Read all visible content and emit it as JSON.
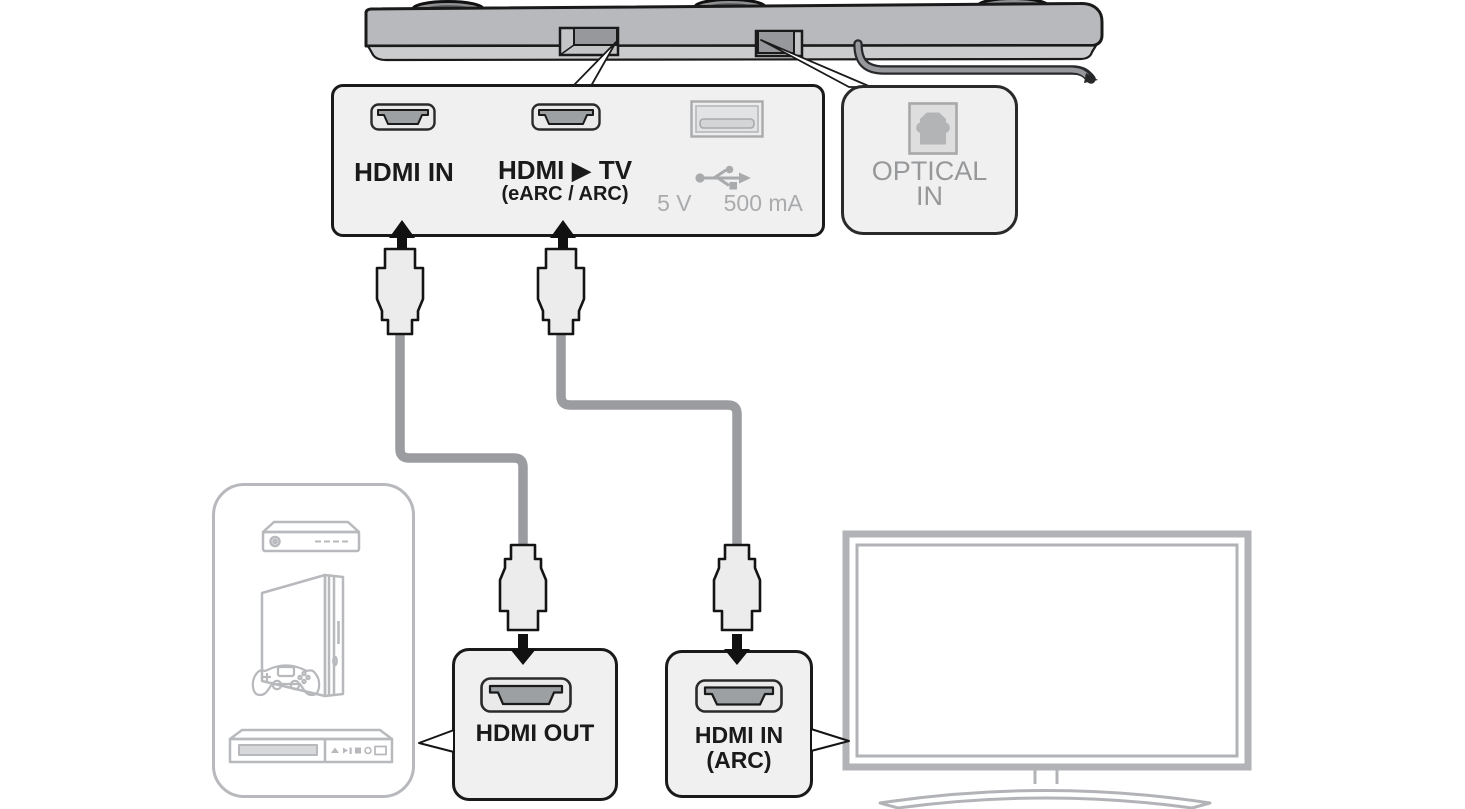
{
  "diagram": {
    "description": "Soundbar rear-panel connection diagram: HDMI sources and TV ARC hookup"
  },
  "rear_panel": {
    "hdmi_in": "HDMI IN",
    "hdmi_tv": "HDMI ▶ TV",
    "hdmi_tv_sub": "(eARC / ARC)",
    "usb_volts": "5 V",
    "usb_current": "500 mA"
  },
  "optical": {
    "line1": "OPTICAL",
    "line2": "IN"
  },
  "hdmi_out": {
    "label": "HDMI OUT"
  },
  "hdmi_in_arc": {
    "line1": "HDMI IN",
    "line2": "(ARC)"
  },
  "colors": {
    "panel_fill": "#f0f0f0",
    "outline": "#1a1a1a",
    "gray_text": "#96989a",
    "soundbar_body": "#b7b9bc",
    "cable": "#9a9ca0",
    "device_outline": "#b7b9bc",
    "tv_outline": "#b1b3b6",
    "port_dark": "#9da0a3"
  }
}
